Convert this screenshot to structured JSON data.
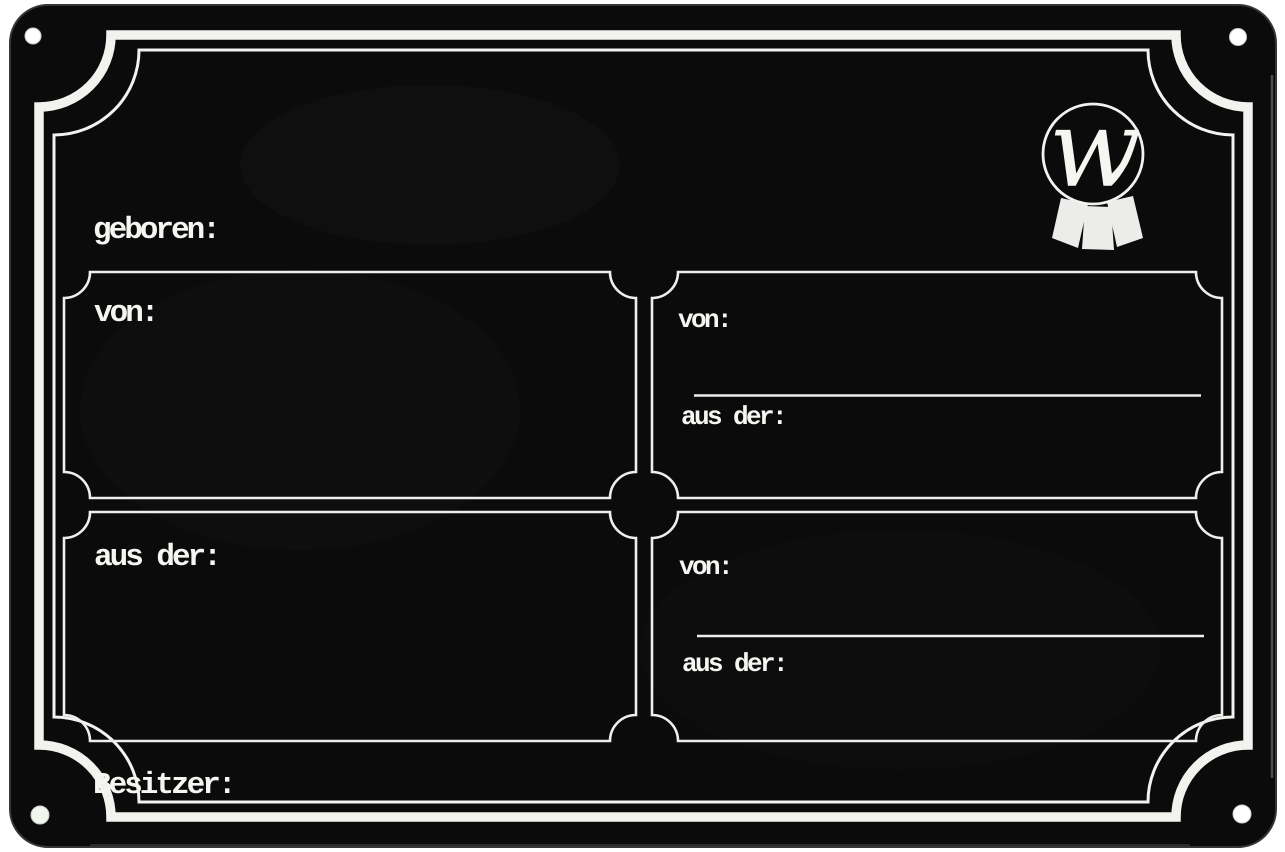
{
  "labels": {
    "geboren": "geboren:",
    "besitzer": "Besitzer:"
  },
  "boxes": {
    "top_left": {
      "von": "von:"
    },
    "bottom_left": {
      "aus_der": "aus der:"
    },
    "top_right": {
      "von": "von:",
      "aus_der": "aus der:"
    },
    "bottom_right": {
      "von": "von:",
      "aus_der": "aus der:"
    }
  },
  "logo": {
    "letter": "w"
  },
  "colors": {
    "plate_black": "#0b0b0c",
    "ink_white": "#f5f5f2"
  }
}
